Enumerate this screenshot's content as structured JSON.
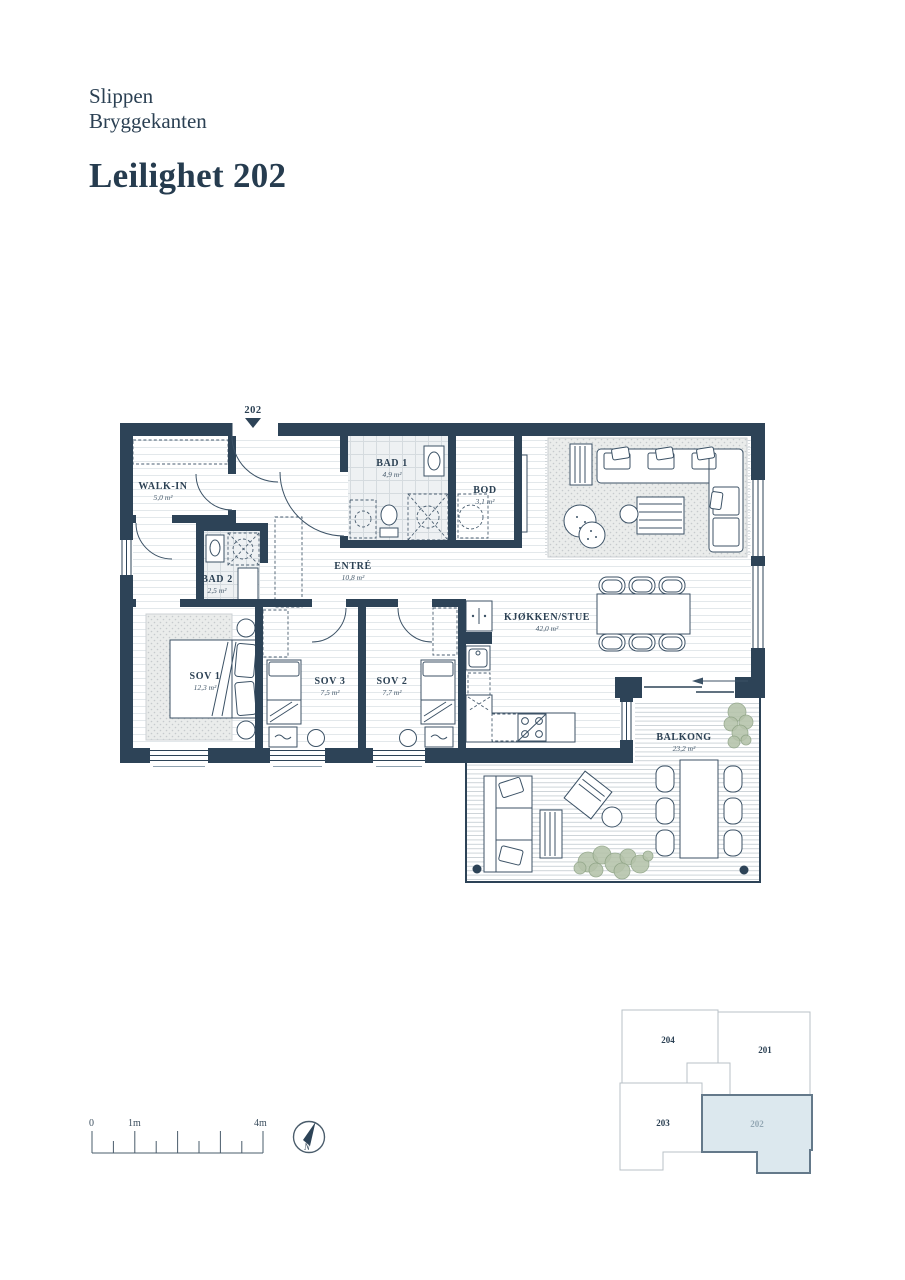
{
  "header": {
    "project_line1": "Slippen",
    "project_line2": "Bryggekanten",
    "title": "Leilighet 202"
  },
  "plan": {
    "entrance_marker": "202",
    "rooms": {
      "walk_in": {
        "name": "WALK-IN",
        "area": "5,0 m²"
      },
      "bad1": {
        "name": "BAD 1",
        "area": "4,9 m²"
      },
      "bod": {
        "name": "BOD",
        "area": "3,1 m²"
      },
      "bad2": {
        "name": "BAD 2",
        "area": "2,5 m²"
      },
      "entre": {
        "name": "ENTRÉ",
        "area": "10,8 m²"
      },
      "sov1": {
        "name": "SOV 1",
        "area": "12,3 m²"
      },
      "sov3": {
        "name": "SOV 3",
        "area": "7,5 m²"
      },
      "sov2": {
        "name": "SOV 2",
        "area": "7,7 m²"
      },
      "kjokken_stue": {
        "name": "KJØKKEN/STUE",
        "area": "42,0 m²"
      },
      "balkong": {
        "name": "BALKONG",
        "area": "23,2 m²"
      }
    }
  },
  "scale_bar": {
    "zero": "0",
    "one": "1m",
    "four": "4m"
  },
  "compass": {
    "north": "N"
  },
  "key_plan": {
    "unit_204": "204",
    "unit_201": "201",
    "unit_203": "203",
    "unit_202": "202",
    "highlighted_unit": "202"
  },
  "colors": {
    "wall_navy": "#2d4357",
    "text_navy": "#2b4053",
    "keyplan_highlight_fill": "#dce8ee",
    "keyplan_highlight_stroke": "#64798a",
    "plant_green": "#b5c3aa"
  }
}
